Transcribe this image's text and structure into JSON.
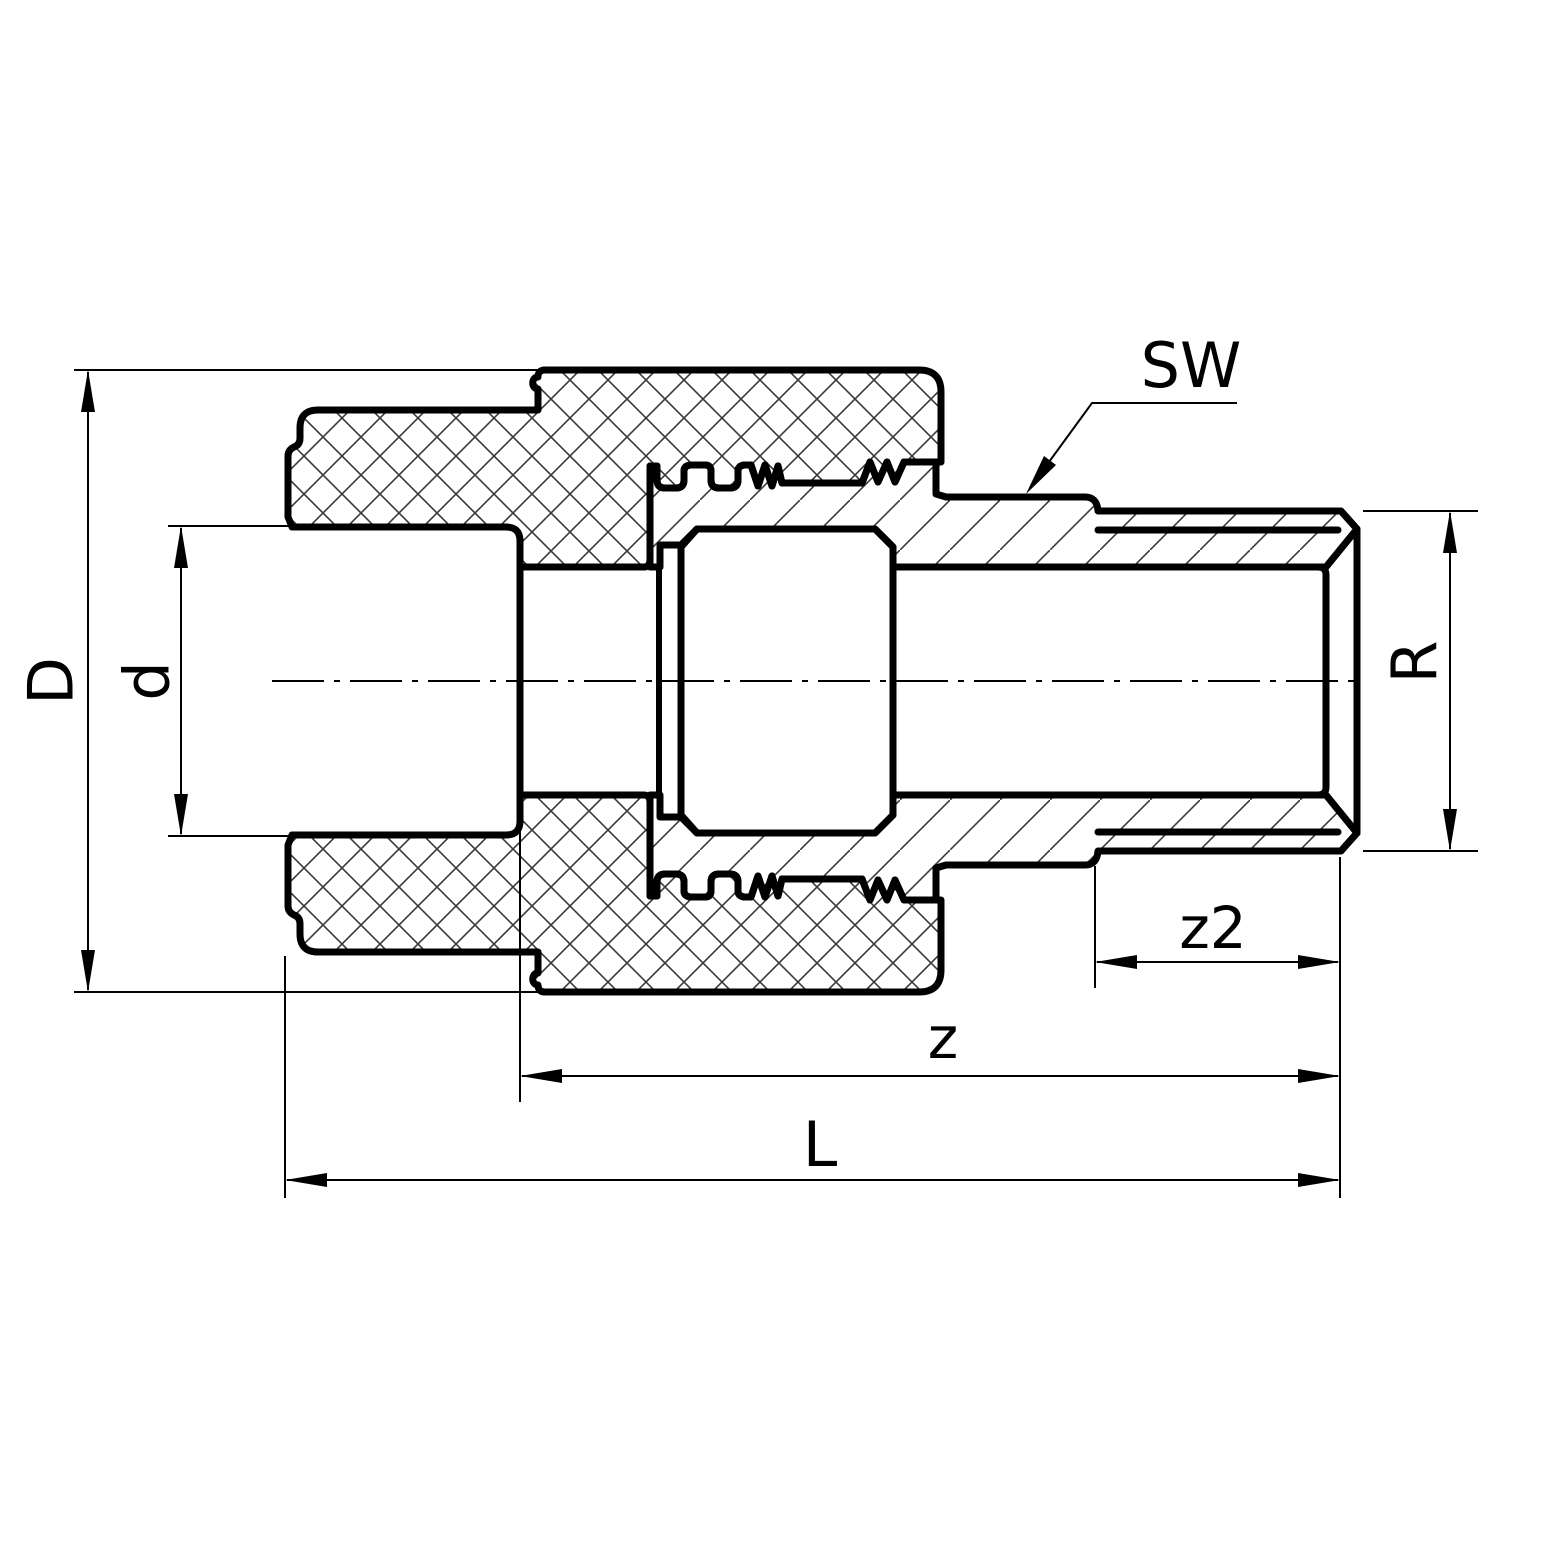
{
  "drawing": {
    "type": "technical-section-drawing",
    "subject": "pipe union adapter fitting, female socket x male thread, cross-section",
    "background_color": "#ffffff",
    "line_color": "#000000",
    "hatch_color": "#3a3a3a",
    "labels": {
      "body_outer_diameter": "D",
      "socket_inner_diameter": "d",
      "wrench_size": "SW",
      "thread_designation": "R",
      "thread_length": "z2",
      "inner_length": "z",
      "overall_length": "L"
    }
  }
}
